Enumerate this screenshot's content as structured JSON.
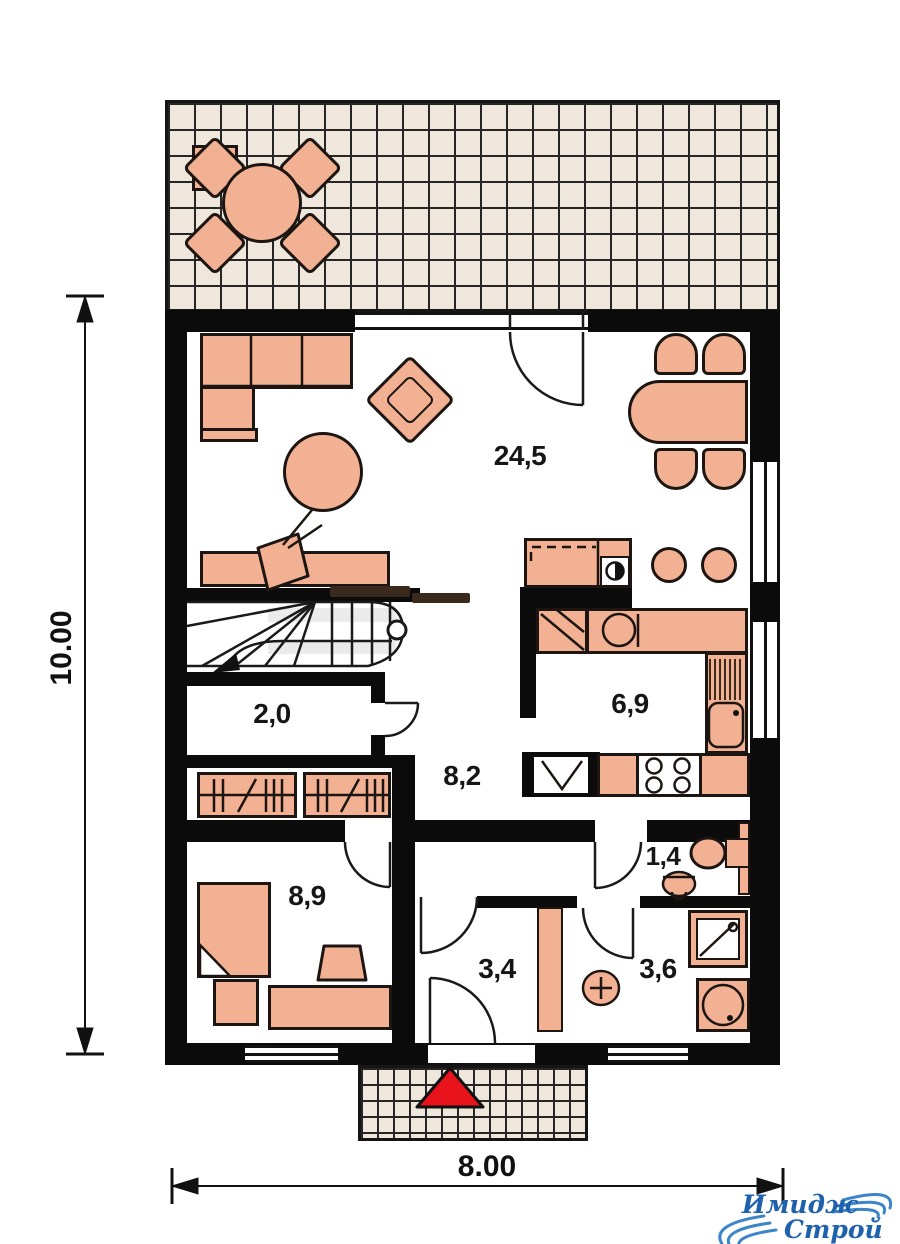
{
  "floor_plan": {
    "rooms": [
      {
        "name": "living-dining-room",
        "area": "24,5"
      },
      {
        "name": "storage-under-stairs",
        "area": "2,0"
      },
      {
        "name": "kitchen",
        "area": "6,9"
      },
      {
        "name": "hall",
        "area": "8,2"
      },
      {
        "name": "bedroom",
        "area": "8,9"
      },
      {
        "name": "wc",
        "area": "1,4"
      },
      {
        "name": "vestibule",
        "area": "3,4"
      },
      {
        "name": "bathroom",
        "area": "3,6"
      }
    ],
    "dimensions": {
      "depth": "10.00",
      "width": "8.00"
    },
    "entrance_marker": "red-triangle"
  },
  "logo": {
    "line1": "Имидж",
    "line2": "Строй"
  },
  "colors": {
    "wall": "#0b0b0b",
    "furniture": "#f1b192",
    "furniture_outline": "#1c1512",
    "tile": "#f0e7dc",
    "grout": "#262626",
    "entrance_red": "#e8131b",
    "logo_text_blue": "#2061ad",
    "logo_swoosh_blue": "#3c85c8"
  }
}
